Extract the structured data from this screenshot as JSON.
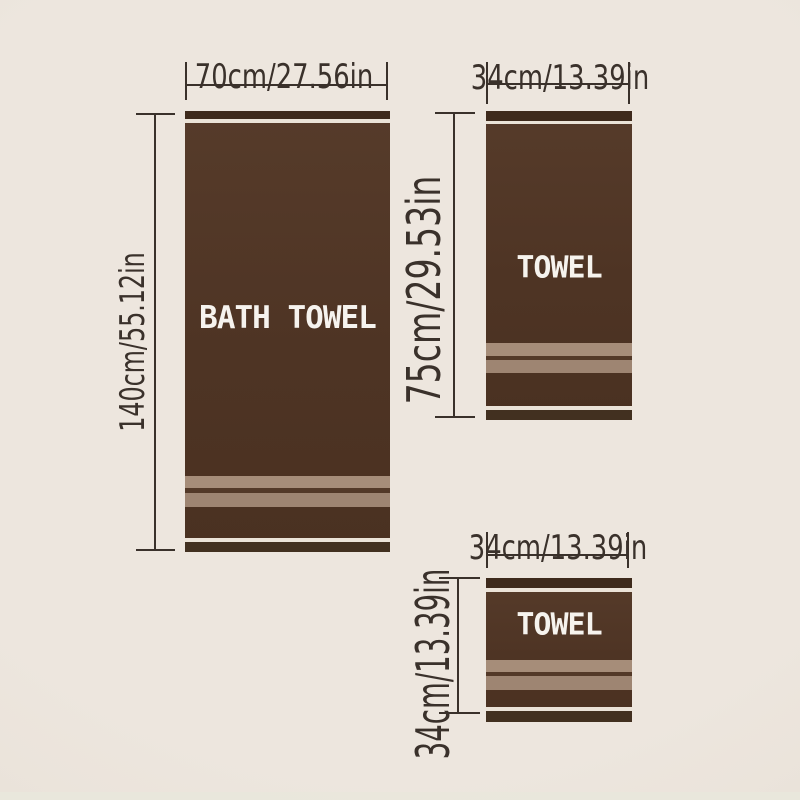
{
  "colors": {
    "bg": "#ede6de",
    "bg_edge": "#e5ddd3",
    "bottom_edge": "#e8e7dc",
    "line": "#3a312b",
    "body_top": "#563b2a",
    "body": "#4e3424",
    "body_deep": "#4a3121",
    "top_strip": "#3e2a1c",
    "cream": "#ebe3d8",
    "band_light": "#a68d79",
    "band_light2": "#9e8572",
    "band_dark": "#533928",
    "bottom_strip": "#423020",
    "label": "#f6f3ee"
  },
  "towels": {
    "bath": {
      "label": "BATH TOWEL",
      "width_label": "70cm/27.56in",
      "height_label": "140cm/55.12in"
    },
    "hand": {
      "label": "TOWEL",
      "width_label": "34cm/13.39in",
      "height_label": "75cm/29.53in"
    },
    "wash": {
      "label": "TOWEL",
      "width_label": "34cm/13.39in",
      "height_label": "34cm/13.39in"
    }
  }
}
